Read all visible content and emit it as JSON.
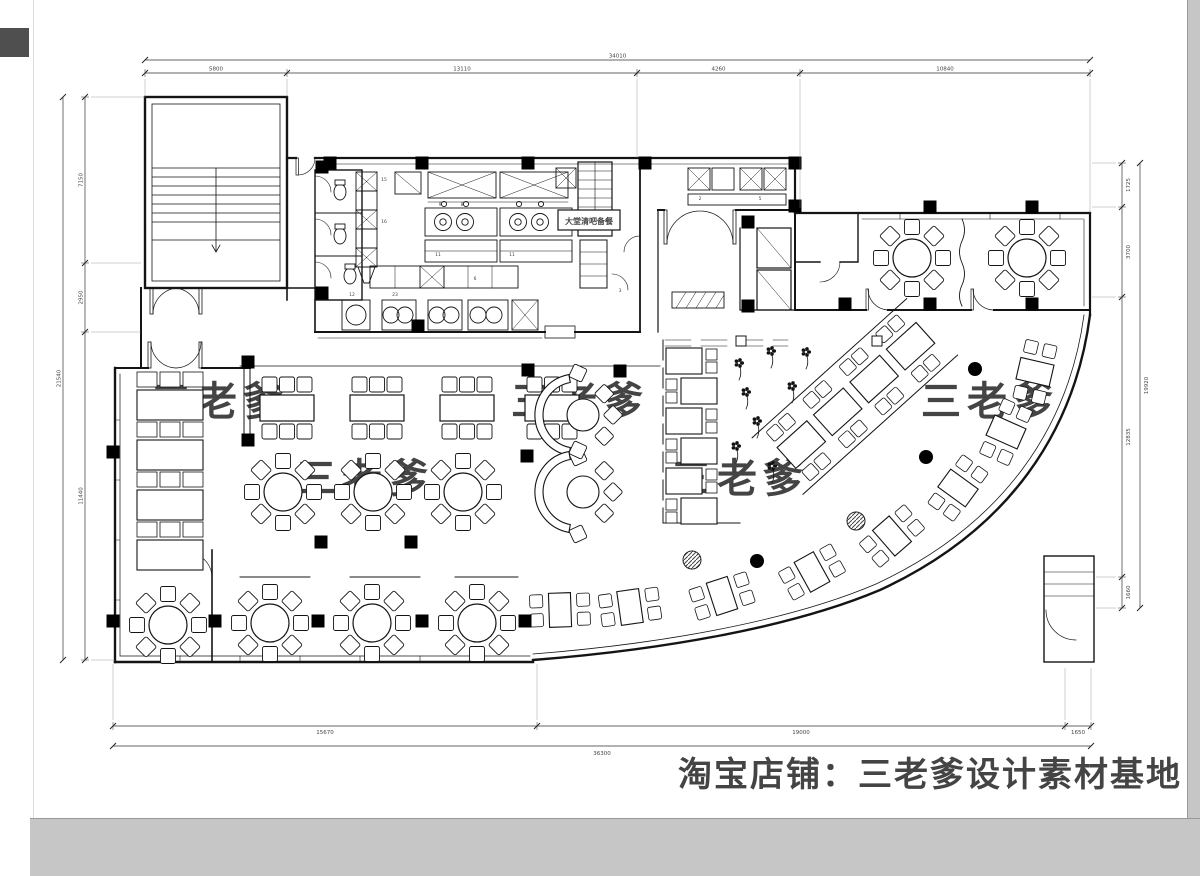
{
  "title": "restaurant-floor-plan-cad-drawing",
  "colors": {
    "line": "#141414",
    "dim_line": "#333333",
    "dim_text": "#444444",
    "watermark_small": "#ededed",
    "watermark_big": "#e4e4e4",
    "desktop_gray": "#c6c6c6",
    "chip_gray": "#4f4f4f",
    "column_black": "#000000"
  },
  "watermarks": {
    "small_text": "三老爹",
    "big_text": "淘宝店铺：三老爹设计素材基地",
    "small_positions": [
      [
        220,
        415
      ],
      [
        580,
        415
      ],
      [
        990,
        415
      ],
      [
        365,
        492
      ],
      [
        740,
        492
      ]
    ]
  },
  "labels": {
    "hall_bar": "大堂清吧备餐"
  },
  "kitchen_tags": [
    [
      "15",
      384,
      181
    ],
    [
      "16",
      384,
      223
    ],
    [
      "9",
      440,
      206
    ],
    [
      "8",
      462,
      206
    ],
    [
      "11",
      438,
      256
    ],
    [
      "11",
      512,
      256
    ],
    [
      "6",
      475,
      280
    ],
    [
      "3",
      620,
      292
    ],
    [
      "2",
      700,
      200
    ],
    [
      "5",
      760,
      200
    ],
    [
      "12",
      352,
      296
    ],
    [
      "23",
      395,
      296
    ]
  ],
  "dimensions": {
    "top": {
      "y_chain": 73,
      "y_overall": 60,
      "ticks": [
        145,
        287,
        637,
        800,
        1090
      ],
      "labels": [
        "5800",
        "13110",
        "4260",
        "10840"
      ],
      "overall": "34010",
      "ext": [
        97,
        97,
        158,
        208,
        213
      ]
    },
    "bottom": {
      "y_chain": 726,
      "y_overall": 746,
      "ticks": [
        113,
        537,
        1065,
        1091
      ],
      "labels": [
        "15670",
        "19000",
        "1650"
      ],
      "overall": "36300",
      "ext": [
        664,
        664,
        668,
        668
      ]
    },
    "left": {
      "x_chain": 85,
      "x_overall": 63,
      "ticks": [
        97,
        263,
        332,
        660
      ],
      "labels": [
        "7150",
        "2950",
        "11440"
      ],
      "overall": "21540",
      "ext": [
        145,
        141,
        141,
        115
      ]
    },
    "right": {
      "x_chain": 1122,
      "x_overall": 1140,
      "ticks": [
        163,
        207,
        297,
        577,
        608
      ],
      "labels": [
        "1725",
        "3700",
        "12835",
        "1660"
      ],
      "overall": "19920",
      "ext": [
        1092,
        1092,
        1092,
        1096,
        1096
      ]
    }
  },
  "furniture": {
    "round_tables": [
      [
        283,
        492
      ],
      [
        373,
        492
      ],
      [
        463,
        492
      ],
      [
        270,
        623
      ],
      [
        372,
        623
      ],
      [
        477,
        623
      ],
      [
        168,
        625
      ],
      [
        912,
        258
      ],
      [
        1027,
        258
      ]
    ],
    "rect_tables": [
      [
        287,
        408
      ],
      [
        377,
        408
      ],
      [
        467,
        408
      ],
      [
        552,
        408
      ]
    ],
    "half_round_booths": [
      [
        576,
        415
      ],
      [
        576,
        492
      ]
    ],
    "left_booth_rows_y": [
      372,
      422,
      472,
      522
    ],
    "center_booth_rows_y": [
      348,
      378,
      408,
      438,
      468,
      498
    ],
    "curve_groups": [
      [
        1035,
        372,
        103
      ],
      [
        1006,
        432,
        114
      ],
      [
        958,
        488,
        126
      ],
      [
        892,
        536,
        139
      ],
      [
        812,
        572,
        151
      ],
      [
        722,
        596,
        162
      ],
      [
        630,
        607,
        172
      ],
      [
        560,
        610,
        178
      ]
    ],
    "diagonal_booths": {
      "x": 782,
      "y": 462,
      "angle": -42,
      "units": 4
    },
    "plants": [
      [
        739,
        363
      ],
      [
        771,
        351
      ],
      [
        746,
        392
      ],
      [
        792,
        386
      ],
      [
        757,
        421
      ],
      [
        736,
        446
      ],
      [
        772,
        466
      ],
      [
        806,
        352
      ]
    ],
    "columns_square": [
      [
        330,
        163
      ],
      [
        422,
        163
      ],
      [
        528,
        163
      ],
      [
        645,
        163
      ],
      [
        795,
        163
      ],
      [
        795,
        206
      ],
      [
        930,
        207
      ],
      [
        1032,
        207
      ],
      [
        930,
        304
      ],
      [
        1032,
        304
      ],
      [
        322,
        167
      ],
      [
        322,
        293
      ],
      [
        418,
        326
      ],
      [
        248,
        362
      ],
      [
        528,
        370
      ],
      [
        620,
        371
      ],
      [
        248,
        440
      ],
      [
        321,
        542
      ],
      [
        411,
        542
      ],
      [
        527,
        456
      ],
      [
        113,
        452
      ],
      [
        113,
        621
      ],
      [
        215,
        621
      ],
      [
        318,
        621
      ],
      [
        422,
        621
      ],
      [
        525,
        621
      ],
      [
        748,
        222
      ],
      [
        748,
        306
      ],
      [
        845,
        304
      ]
    ],
    "columns_round_black": [
      [
        975,
        369
      ],
      [
        926,
        457
      ],
      [
        757,
        561
      ]
    ],
    "columns_round_hatched": [
      [
        856,
        521
      ],
      [
        692,
        560
      ]
    ],
    "columns_white": [
      [
        741,
        341
      ],
      [
        877,
        341
      ]
    ],
    "toilets": [
      [
        340,
        192
      ],
      [
        340,
        236
      ],
      [
        350,
        276
      ]
    ]
  }
}
